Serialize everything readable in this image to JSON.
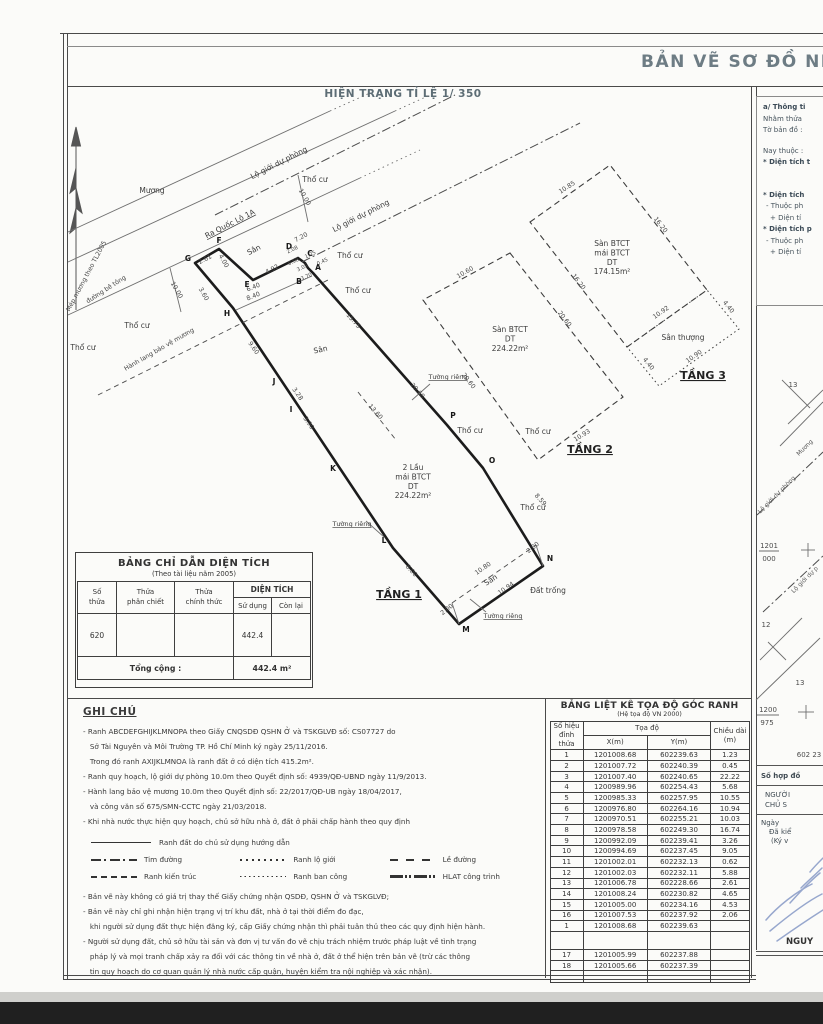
{
  "title": "BẢN VẼ SƠ ĐỒ NH",
  "subtitle": "HIỆN TRẠNG TỈ LỆ 1/ 350",
  "area_table": {
    "title": "BẢNG CHỈ DẪN DIỆN TÍCH",
    "subtitle": "(Theo tài liệu năm 2005)",
    "h_so_thua": "Số\nthửa",
    "h_phan_chiet": "Thửa\nphân chiết",
    "h_chinh_thuc": "Thửa\nchính thức",
    "h_dien_tich": "DIỆN TÍCH",
    "h_su_dung": "Sử dụng",
    "h_con_lai": "Còn lại",
    "row": {
      "so_thua": "620",
      "phan_chiet": "",
      "chinh_thuc": "",
      "su_dung": "442.4",
      "con_lai": ""
    },
    "total_label": "Tổng cộng :",
    "total_value": "442.4 m²"
  },
  "coord_table": {
    "title": "BẢNG LIỆT KÊ TỌA ĐỘ GÓC RANH",
    "subtitle": "(Hệ tọa độ VN 2000)",
    "h_point": "Số hiệu\nđỉnh thửa",
    "h_coord": "Tọa độ",
    "h_x": "X(m)",
    "h_y": "Y(m)",
    "h_len": "Chiều dài\n(m)",
    "rows": [
      [
        "1",
        "1201008.68",
        "602239.63",
        "1.23"
      ],
      [
        "2",
        "1201007.72",
        "602240.39",
        "0.45"
      ],
      [
        "3",
        "1201007.40",
        "602240.65",
        "22.22"
      ],
      [
        "4",
        "1200989.96",
        "602254.43",
        "5.68"
      ],
      [
        "5",
        "1200985.33",
        "602257.95",
        "10.55"
      ],
      [
        "6",
        "1200976.80",
        "602264.16",
        "10.94"
      ],
      [
        "7",
        "1200970.51",
        "602255.21",
        "10.03"
      ],
      [
        "8",
        "1200978.58",
        "602249.30",
        "16.74"
      ],
      [
        "9",
        "1200992.09",
        "602239.41",
        "3.26"
      ],
      [
        "10",
        "1200994.69",
        "602237.45",
        "9.05"
      ],
      [
        "11",
        "1201002.01",
        "602232.13",
        "0.62"
      ],
      [
        "12",
        "1201002.03",
        "602232.11",
        "5.88"
      ],
      [
        "13",
        "1201006.78",
        "602228.66",
        "2.61"
      ],
      [
        "14",
        "1201008.24",
        "602230.82",
        "4.65"
      ],
      [
        "15",
        "1201005.00",
        "602234.16",
        "4.53"
      ],
      [
        "16",
        "1201007.53",
        "602237.92",
        "2.06"
      ],
      [
        "1",
        "1201008.68",
        "602239.63",
        ""
      ]
    ],
    "extra_rows": [
      [
        "17",
        "1201005.99",
        "602237.88",
        ""
      ],
      [
        "18",
        "1201005.66",
        "602237.39",
        ""
      ]
    ]
  },
  "ghi_chu": {
    "title": "GHI CHÚ",
    "bullets": [
      "- Ranh ABCDEFGHIJKLMNOPA theo Giấy CNQSDĐ QSHN Ở và TSKGLVĐ số: CS07727 do",
      "   Sở Tài Nguyên và Môi Trường TP. Hồ Chí Minh ký ngày 25/11/2016.",
      "   Trong đó ranh AXIJKLMNOA là ranh đất ở có diện tích 415.2m².",
      "- Ranh quy hoạch, lộ giới dự phòng 10.0m theo Quyết định số: 4939/QĐ-UBND ngày 11/9/2013.",
      "- Hành lang bảo vệ mương 10.0m theo Quyết định số: 22/2017/QĐ-UB ngày 18/04/2017,",
      "   và công văn số 675/SMN-CCTC ngày 21/03/2018.",
      "- Khi nhà nước thực hiện quy hoạch, chủ sở hữu nhà ở, đất ở phải chấp hành theo quy định"
    ],
    "legend_row1": {
      "style": "solid",
      "label": "Ranh  đất do chủ sử dụng hướng dẫn"
    },
    "legend_rows": [
      [
        {
          "style": "dashdot",
          "label": "Tim đường"
        },
        {
          "style": "dotted",
          "label": "Ranh lộ giới"
        },
        {
          "style": "dashwide",
          "label": "Lề đường"
        }
      ],
      [
        {
          "style": "dashed",
          "label": "Ranh kiến trúc"
        },
        {
          "style": "dotfine",
          "label": "Ranh ban công"
        },
        {
          "style": "dashdotdot",
          "label": "HLAT công trình"
        }
      ]
    ],
    "notes": [
      "- Bản vẽ này không có giá trị thay thế Giấy chứng nhận QSDĐ, QSHN Ở và TSKGLVĐ;",
      "- Bản vẽ này chỉ ghi nhận hiện trạng vị trí khu đất, nhà ở tại thời điểm đo đạc,",
      "   khi người sử dụng đất thực hiện đăng ký, cấp Giấy chứng nhận thì phải tuân thủ theo các quy định hiện hành.",
      "- Người sử dụng đất, chủ sở hữu tài sản và đơn vị tư vấn đo vẽ chịu trách nhiệm trước pháp luật về tình trạng",
      "   pháp lý và mọi tranh chấp xảy ra đối với các thông tin về nhà ở, đất ở thể hiện trên bản vẽ (trừ các thông",
      "   tin quy hoạch do cơ quan quản lý nhà nước cấp quận, huyện kiểm tra nội nghiệp và xác nhận)."
    ]
  },
  "info_panel": {
    "lines": [
      {
        "t": "a/ Thông ti",
        "cls": "b"
      },
      {
        "t": "Nhằm thửa",
        "cls": ""
      },
      {
        "t": "Tờ bản đồ :",
        "cls": ""
      },
      {
        "t": "Nay thuộc :",
        "cls": "g1"
      },
      {
        "t": "* Diện tích t",
        "cls": "b"
      },
      {
        "t": "* Diện tích",
        "cls": "b g2"
      },
      {
        "t": "- Thuộc ph",
        "cls": "i1"
      },
      {
        "t": "+ Diện tí",
        "cls": "i2"
      },
      {
        "t": "* Diện tích p",
        "cls": "b"
      },
      {
        "t": "- Thuộc ph",
        "cls": "i1"
      },
      {
        "t": "+ Diện tí",
        "cls": "i2"
      }
    ]
  },
  "sign_block": {
    "contract": "Số hợp đồ",
    "nguoi": "NGƯỜI",
    "chu": "CHỦ S",
    "ngay": "Ngày",
    "da_kiem": "Đã kiể",
    "ky_ve": "(Ký v",
    "name": "NGUY"
  },
  "map": {
    "polys": [
      {
        "name": "parcel-boundary",
        "cls": "parcel",
        "pts": "313,273 308,268 305,263 298,258 253,280 219,249 195,263 233,308 393,548 459,624 543,566 483,468 447,425"
      },
      {
        "name": "floor2-slab",
        "cls": "dashedpoly",
        "pts": "510,253 623,397 538,460 423,300"
      },
      {
        "name": "floor3-slab",
        "cls": "dashedpoly",
        "pts": "530,222 610,165 707,290 627,347"
      },
      {
        "name": "floor3-terrace",
        "cls": "dottedpoly",
        "pts": "627,347 707,290 739,329 659,386"
      }
    ],
    "lines": [
      {
        "cls": "thin",
        "x1": 68,
        "y1": 232,
        "x2": 330,
        "y2": 111
      },
      {
        "cls": "dotted",
        "x1": 330,
        "y1": 111,
        "x2": 370,
        "y2": 93
      },
      {
        "cls": "thin",
        "x1": 68,
        "y1": 262,
        "x2": 395,
        "y2": 111
      },
      {
        "cls": "dotted",
        "x1": 395,
        "y1": 111,
        "x2": 430,
        "y2": 95
      },
      {
        "cls": "thin",
        "x1": 68,
        "y1": 315,
        "x2": 360,
        "y2": 178
      },
      {
        "cls": "dotted",
        "x1": 360,
        "y1": 178,
        "x2": 420,
        "y2": 150
      },
      {
        "cls": "dashdot",
        "x1": 215,
        "y1": 215,
        "x2": 455,
        "y2": 95
      },
      {
        "cls": "dashdot",
        "x1": 302,
        "y1": 262,
        "x2": 580,
        "y2": 123
      },
      {
        "cls": "dashed",
        "x1": 98,
        "y1": 395,
        "x2": 330,
        "y2": 279
      },
      {
        "cls": "thin",
        "x1": 170,
        "y1": 268,
        "x2": 181,
        "y2": 312
      },
      {
        "cls": "thin",
        "x1": 298,
        "y1": 175,
        "x2": 308,
        "y2": 222
      },
      {
        "cls": "dashed",
        "x1": 452,
        "y1": 603,
        "x2": 536,
        "y2": 545
      },
      {
        "cls": "thin",
        "x1": 452,
        "y1": 603,
        "x2": 459,
        "y2": 624
      },
      {
        "cls": "thin",
        "x1": 536,
        "y1": 545,
        "x2": 543,
        "y2": 566
      },
      {
        "cls": "thin",
        "x1": 236,
        "y1": 310,
        "x2": 312,
        "y2": 276
      },
      {
        "cls": "dashed",
        "x1": 358,
        "y1": 392,
        "x2": 396,
        "y2": 440
      },
      {
        "cls": "thin",
        "x1": 430,
        "y1": 384,
        "x2": 412,
        "y2": 400
      },
      {
        "cls": "thin",
        "x1": 366,
        "y1": 521,
        "x2": 384,
        "y2": 537
      },
      {
        "cls": "thin",
        "x1": 486,
        "y1": 612,
        "x2": 470,
        "y2": 599
      }
    ],
    "labels": [
      {
        "t": "Mương",
        "x": 152,
        "y": 193
      },
      {
        "t": "Ra Quốc Lộ 1A",
        "x": 231,
        "y": 226,
        "r": -27,
        "cls": "name-u"
      },
      {
        "t": "Lộ giới dự phòng",
        "x": 280,
        "y": 165,
        "r": -27
      },
      {
        "t": "Lộ giới dự phòng",
        "x": 362,
        "y": 218,
        "r": -27
      },
      {
        "t": "Mép mương theo TL2005",
        "x": 88,
        "y": 277,
        "r": -62,
        "cls": "dim"
      },
      {
        "t": "đường bê tông",
        "x": 107,
        "y": 291,
        "r": -33,
        "cls": "dim"
      },
      {
        "t": "Hành lang bảo vệ mương",
        "x": 160,
        "y": 351,
        "r": -30,
        "cls": "dim"
      },
      {
        "t": "Thổ cư",
        "x": 83,
        "y": 350
      },
      {
        "t": "Thổ cư",
        "x": 137,
        "y": 328
      },
      {
        "t": "Thổ cư",
        "x": 315,
        "y": 182
      },
      {
        "t": "Thổ cư",
        "x": 350,
        "y": 258
      },
      {
        "t": "Thổ cư",
        "x": 358,
        "y": 293
      },
      {
        "t": "Thổ cư",
        "x": 470,
        "y": 433
      },
      {
        "t": "Thổ cư",
        "x": 538,
        "y": 434
      },
      {
        "t": "Thổ cư",
        "x": 533,
        "y": 510
      },
      {
        "t": "Đất trống",
        "x": 548,
        "y": 593
      },
      {
        "t": "Sân",
        "x": 255,
        "y": 252,
        "r": -27
      },
      {
        "t": "Sân",
        "x": 321,
        "y": 352,
        "r": -12
      },
      {
        "t": "Sân",
        "x": 492,
        "y": 582,
        "r": -33
      },
      {
        "t": "Tường riêng",
        "x": 448,
        "y": 379,
        "cls": "wall"
      },
      {
        "t": "Tường riêng",
        "x": 352,
        "y": 526,
        "cls": "wall"
      },
      {
        "t": "Tường riêng",
        "x": 503,
        "y": 618,
        "cls": "wall"
      },
      {
        "t": "TẦNG 1",
        "x": 399,
        "y": 598,
        "cls": "floor"
      },
      {
        "t": "TẦNG 2",
        "x": 590,
        "y": 453,
        "cls": "floor"
      },
      {
        "t": "TẦNG 3",
        "x": 703,
        "y": 379,
        "cls": "floor"
      },
      {
        "t": "2 Lầu\nmái BTCT\nDT\n224.22m²",
        "x": 413,
        "y": 470,
        "cls": "bldg"
      },
      {
        "t": "Sàn BTCT\nDT\n224.22m²",
        "x": 510,
        "y": 332,
        "cls": "bldg"
      },
      {
        "t": "Sàn BTCT\nmái BTCT\nDT\n174.15m²",
        "x": 612,
        "y": 246,
        "cls": "bldg"
      },
      {
        "t": "Sân thượng",
        "x": 683,
        "y": 340,
        "cls": "bldg"
      },
      {
        "t": "A",
        "x": 318,
        "y": 270,
        "cls": "pt"
      },
      {
        "t": "B",
        "x": 299,
        "y": 284,
        "cls": "pt"
      },
      {
        "t": "C",
        "x": 310,
        "y": 256,
        "cls": "pt"
      },
      {
        "t": "D",
        "x": 289,
        "y": 249,
        "cls": "pt"
      },
      {
        "t": "E",
        "x": 247,
        "y": 287,
        "cls": "pt"
      },
      {
        "t": "F",
        "x": 219,
        "y": 243,
        "cls": "pt"
      },
      {
        "t": "G",
        "x": 188,
        "y": 261,
        "cls": "pt"
      },
      {
        "t": "H",
        "x": 227,
        "y": 316,
        "cls": "pt"
      },
      {
        "t": "J",
        "x": 274,
        "y": 384,
        "cls": "pt"
      },
      {
        "t": "I",
        "x": 291,
        "y": 412,
        "cls": "pt"
      },
      {
        "t": "K",
        "x": 333,
        "y": 471,
        "cls": "pt"
      },
      {
        "t": "L",
        "x": 384,
        "y": 543,
        "cls": "pt"
      },
      {
        "t": "M",
        "x": 466,
        "y": 632,
        "cls": "pt"
      },
      {
        "t": "N",
        "x": 550,
        "y": 561,
        "cls": "pt"
      },
      {
        "t": "O",
        "x": 492,
        "y": 463,
        "cls": "pt"
      },
      {
        "t": "P",
        "x": 453,
        "y": 418,
        "cls": "pt"
      },
      {
        "t": "15.75",
        "x": 352,
        "y": 322,
        "r": 48,
        "cls": "dim"
      },
      {
        "t": "20.60",
        "x": 416,
        "y": 392,
        "r": 48,
        "cls": "dim"
      },
      {
        "t": "8.59",
        "x": 539,
        "y": 501,
        "r": 48,
        "cls": "dim"
      },
      {
        "t": "9.60",
        "x": 252,
        "y": 349,
        "r": 55,
        "cls": "dim"
      },
      {
        "t": "3.28",
        "x": 296,
        "y": 395,
        "r": 55,
        "cls": "dim"
      },
      {
        "t": "3.90",
        "x": 307,
        "y": 424,
        "r": 55,
        "cls": "dim"
      },
      {
        "t": "13.60",
        "x": 374,
        "y": 413,
        "r": 48,
        "cls": "dim"
      },
      {
        "t": "8.00",
        "x": 410,
        "y": 572,
        "r": 48,
        "cls": "dim"
      },
      {
        "t": "2.00",
        "x": 448,
        "y": 611,
        "r": -38,
        "cls": "dim"
      },
      {
        "t": "2.00",
        "x": 534,
        "y": 549,
        "r": -38,
        "cls": "dim"
      },
      {
        "t": "10.80",
        "x": 484,
        "y": 570,
        "r": -35,
        "cls": "dim"
      },
      {
        "t": "10.94",
        "x": 507,
        "y": 590,
        "r": -35,
        "cls": "dim"
      },
      {
        "t": "7.20",
        "x": 302,
        "y": 239,
        "r": -28,
        "cls": "dim"
      },
      {
        "t": "4.92",
        "x": 273,
        "y": 271,
        "r": -28,
        "cls": "dim"
      },
      {
        "t": "2.61",
        "x": 206,
        "y": 261,
        "r": -28,
        "cls": "dim"
      },
      {
        "t": "4.00",
        "x": 222,
        "y": 262,
        "r": 60,
        "cls": "dim"
      },
      {
        "t": "6.40",
        "x": 254,
        "y": 289,
        "r": -22,
        "cls": "dim"
      },
      {
        "t": "8.40",
        "x": 254,
        "y": 298,
        "r": -22,
        "cls": "dim"
      },
      {
        "t": "10.00",
        "x": 175,
        "y": 291,
        "r": 60,
        "cls": "dim"
      },
      {
        "t": "10.00",
        "x": 303,
        "y": 198,
        "r": 60,
        "cls": "dim"
      },
      {
        "t": "3.60",
        "x": 202,
        "y": 295,
        "r": 60,
        "cls": "dim"
      },
      {
        "t": "2.08",
        "x": 293,
        "y": 251,
        "r": -25,
        "cls": "dimxs"
      },
      {
        "t": "1.25",
        "x": 311,
        "y": 256,
        "r": -25,
        "cls": "dimxs"
      },
      {
        "t": "0.45",
        "x": 323,
        "y": 263,
        "r": -25,
        "cls": "dimxs"
      },
      {
        "t": "3.05",
        "x": 303,
        "y": 269,
        "r": -25,
        "cls": "dimxs"
      },
      {
        "t": "0.58",
        "x": 294,
        "y": 263,
        "r": -25,
        "cls": "dimxs"
      },
      {
        "t": "3.70",
        "x": 307,
        "y": 278,
        "r": -25,
        "cls": "dimxs"
      },
      {
        "t": "10.60",
        "x": 466,
        "y": 274,
        "r": -30,
        "cls": "dim"
      },
      {
        "t": "20.60",
        "x": 563,
        "y": 320,
        "r": 52,
        "cls": "dim"
      },
      {
        "t": "20.60",
        "x": 467,
        "y": 382,
        "r": 52,
        "cls": "dim"
      },
      {
        "t": "10.93",
        "x": 583,
        "y": 437,
        "r": -32,
        "cls": "dim"
      },
      {
        "t": "10.85",
        "x": 568,
        "y": 189,
        "r": -33,
        "cls": "dim"
      },
      {
        "t": "16.20",
        "x": 659,
        "y": 226,
        "r": 52,
        "cls": "dim"
      },
      {
        "t": "16.20",
        "x": 577,
        "y": 283,
        "r": 52,
        "cls": "dim"
      },
      {
        "t": "10.92",
        "x": 662,
        "y": 314,
        "r": -35,
        "cls": "dim"
      },
      {
        "t": "4.40",
        "x": 727,
        "y": 308,
        "r": 52,
        "cls": "dim"
      },
      {
        "t": "4.40",
        "x": 647,
        "y": 365,
        "r": 52,
        "cls": "dim"
      },
      {
        "t": "10.90",
        "x": 695,
        "y": 358,
        "r": -35,
        "cls": "dim"
      }
    ]
  },
  "minimap": {
    "lines": [
      {
        "cls": "thin",
        "x1": 788,
        "y1": 424,
        "x2": 823,
        "y2": 390
      },
      {
        "cls": "thin",
        "x1": 780,
        "y1": 446,
        "x2": 823,
        "y2": 402
      },
      {
        "cls": "dashdot",
        "x1": 757,
        "y1": 515,
        "x2": 823,
        "y2": 452
      },
      {
        "cls": "dashdot",
        "x1": 763,
        "y1": 612,
        "x2": 823,
        "y2": 556
      },
      {
        "cls": "thin",
        "x1": 782,
        "y1": 380,
        "x2": 810,
        "y2": 408
      },
      {
        "cls": "thin",
        "x1": 760,
        "y1": 660,
        "x2": 802,
        "y2": 618
      },
      {
        "cls": "thin",
        "x1": 756,
        "y1": 700,
        "x2": 820,
        "y2": 638
      },
      {
        "cls": "thin",
        "x1": 768,
        "y1": 642,
        "x2": 786,
        "y2": 660
      },
      {
        "cls": "thin",
        "x1": 801,
        "y1": 550,
        "x2": 815,
        "y2": 550
      },
      {
        "cls": "thin",
        "x1": 808,
        "y1": 543,
        "x2": 808,
        "y2": 557
      },
      {
        "cls": "thin",
        "x1": 798,
        "y1": 712,
        "x2": 814,
        "y2": 712
      },
      {
        "cls": "thin",
        "x1": 806,
        "y1": 705,
        "x2": 806,
        "y2": 719
      },
      {
        "cls": "thin",
        "x1": 759,
        "y1": 551,
        "x2": 779,
        "y2": 551
      },
      {
        "cls": "thin",
        "x1": 757,
        "y1": 715,
        "x2": 779,
        "y2": 715
      }
    ],
    "labels": [
      {
        "t": "Mương",
        "x": 806,
        "y": 449,
        "r": -45,
        "cls": "mini-s"
      },
      {
        "t": "Lộ giới dự phòng",
        "x": 778,
        "y": 496,
        "r": -45,
        "cls": "mini-s"
      },
      {
        "t": "Lộ giới dự p",
        "x": 806,
        "y": 581,
        "r": -45,
        "cls": "mini-s"
      },
      {
        "t": "1201",
        "x": 769,
        "y": 548,
        "cls": "mini"
      },
      {
        "t": "000",
        "x": 769,
        "y": 561,
        "cls": "mini"
      },
      {
        "t": "1200",
        "x": 768,
        "y": 712,
        "cls": "mini"
      },
      {
        "t": "975",
        "x": 767,
        "y": 725,
        "cls": "mini"
      },
      {
        "t": "602 23",
        "x": 809,
        "y": 757,
        "cls": "mini"
      },
      {
        "t": "12",
        "x": 766,
        "y": 627,
        "cls": "mini"
      },
      {
        "t": "13",
        "x": 793,
        "y": 387,
        "cls": "mini"
      },
      {
        "t": "13",
        "x": 800,
        "y": 685,
        "cls": "mini"
      }
    ]
  }
}
